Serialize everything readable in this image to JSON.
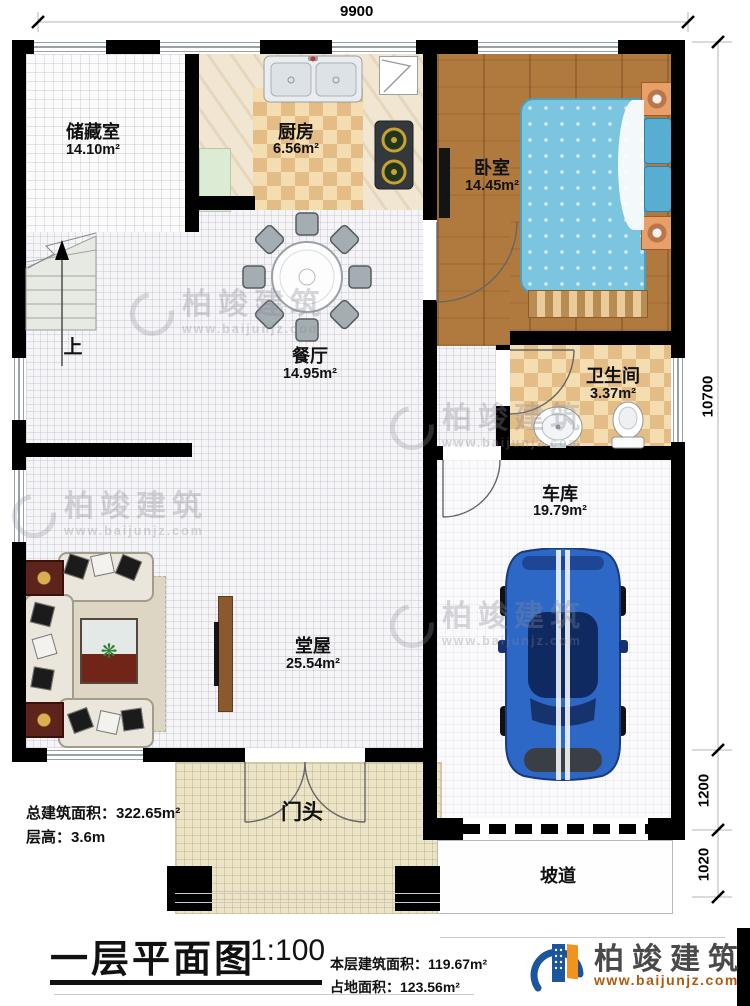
{
  "rooms": {
    "storage": {
      "name": "储藏室",
      "area": "14.10m²"
    },
    "kitchen": {
      "name": "厨房",
      "area": "6.56m²"
    },
    "bedroom": {
      "name": "卧室",
      "area": "14.45m²"
    },
    "dining": {
      "name": "餐厅",
      "area": "14.95m²"
    },
    "bathroom": {
      "name": "卫生间",
      "area": "3.37m²"
    },
    "garage": {
      "name": "车库",
      "area": "19.79m²"
    },
    "hall": {
      "name": "堂屋",
      "area": "25.54m²"
    },
    "porch": {
      "name": "门头"
    },
    "ramp": {
      "name": "坡道"
    }
  },
  "stairs": {
    "up_label": "上"
  },
  "dims": {
    "top": "9900",
    "right_upper": "10700",
    "right_mid": "1200",
    "right_lower": "1020"
  },
  "notes": {
    "total_area": "总建筑面积：322.65m²",
    "floor_height": "层高：3.6m"
  },
  "titleblock": {
    "title": "一层平面图",
    "scale": "1:100",
    "floor_area": "本层建筑面积：119.67m²",
    "footprint_area": "占地面积：123.56m²"
  },
  "brand": {
    "name": "柏竣建筑",
    "website": "www.baijunjz.com"
  },
  "colors": {
    "wall": "#000000",
    "wood_floor": "#b07a3e",
    "bed_blue": "#7cc5de",
    "car_blue": "#2d68c6",
    "kitchen_tile": "#e3bd85",
    "porch_tile": "#ece4c8",
    "brand_orange": "#b05a10",
    "brand_blue": "#1b559e"
  }
}
